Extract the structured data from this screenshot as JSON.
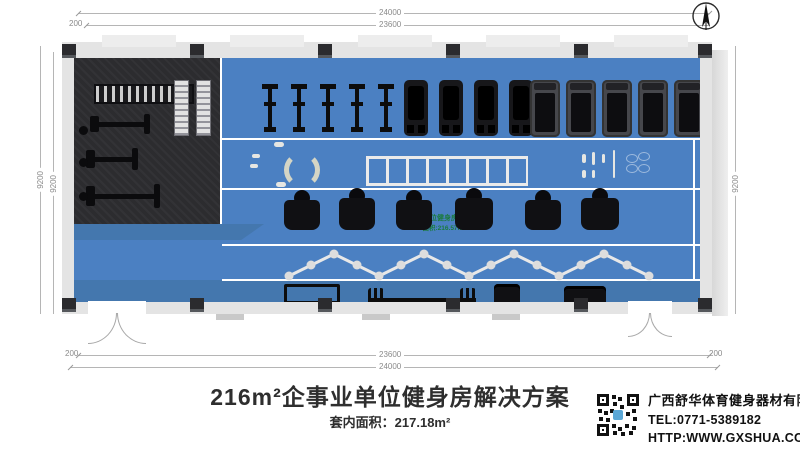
{
  "dimensions": {
    "top_outer": "24000",
    "top_inner": "23600",
    "top_offset_left": "200",
    "bottom_inner": "23600",
    "bottom_outer": "24000",
    "bottom_offset_left": "200",
    "bottom_offset_right": "200",
    "left_inner": "9200",
    "left_outer": "9200",
    "right_inner": "9200",
    "right_outer": "9200"
  },
  "plan": {
    "watermark_line1": "企事业单位健身房解决方案",
    "watermark_line2": "面积:216.57m²",
    "items": [
      {
        "type": "bike",
        "x": 188,
        "y": 26,
        "w": 16,
        "h": 48,
        "count": 5,
        "gap": 29
      },
      {
        "type": "climber",
        "x": 330,
        "y": 22,
        "w": 24,
        "h": 56,
        "count": 4,
        "gap": 35
      },
      {
        "type": "treadmill",
        "x": 456,
        "y": 22,
        "w": 30,
        "h": 57,
        "count": 5,
        "gap": 36
      },
      {
        "type": "machine",
        "x": 208,
        "y": 132,
        "w": 40,
        "h": 44
      },
      {
        "type": "machine",
        "x": 262,
        "y": 130,
        "w": 42,
        "h": 46
      },
      {
        "type": "machine",
        "x": 320,
        "y": 132,
        "w": 40,
        "h": 44
      },
      {
        "type": "machine",
        "x": 378,
        "y": 130,
        "w": 44,
        "h": 46
      },
      {
        "type": "machine",
        "x": 448,
        "y": 132,
        "w": 42,
        "h": 44
      },
      {
        "type": "machine",
        "x": 504,
        "y": 130,
        "w": 44,
        "h": 46
      },
      {
        "type": "rack",
        "x": 210,
        "y": 226,
        "w": 50,
        "h": 32
      },
      {
        "type": "barbell",
        "x": 294,
        "y": 230,
        "w": 108,
        "h": 24
      },
      {
        "type": "machine-sm",
        "x": 420,
        "y": 226,
        "w": 26,
        "h": 30
      },
      {
        "type": "machine-sm",
        "x": 490,
        "y": 228,
        "w": 42,
        "h": 26
      },
      {
        "type": "dbrack",
        "x": 20,
        "y": 26,
        "w": 96,
        "h": 16
      },
      {
        "type": "rack-light",
        "x": 100,
        "y": 22,
        "w": 13,
        "h": 54,
        "count": 2,
        "gap": 22
      },
      {
        "type": "station",
        "x": 16,
        "y": 58,
        "w": 60,
        "h": 16
      },
      {
        "type": "station",
        "x": 12,
        "y": 92,
        "w": 52,
        "h": 18
      },
      {
        "type": "station",
        "x": 12,
        "y": 128,
        "w": 74,
        "h": 20
      },
      {
        "type": "post",
        "x": 5,
        "y": 68,
        "w": 9,
        "h": 9
      },
      {
        "type": "post",
        "x": 5,
        "y": 100,
        "w": 9,
        "h": 9
      },
      {
        "type": "post",
        "x": 5,
        "y": 134,
        "w": 9,
        "h": 9
      }
    ]
  },
  "footer": {
    "title": "216m²企事业单位健身房解决方案",
    "area_label": "套内面积：217.18m²",
    "company_name": "广西舒华体育健身器材有限公司",
    "company_tel": "TEL:0771-5389182",
    "company_url": "HTTP:WWW.GXSHUA.COM"
  },
  "colors": {
    "floor_blue": "#4b80c2",
    "floor_dark": "#2c2c2f",
    "wall_gray": "#e4e4e4",
    "watermark_green": "#1b7a3d"
  }
}
